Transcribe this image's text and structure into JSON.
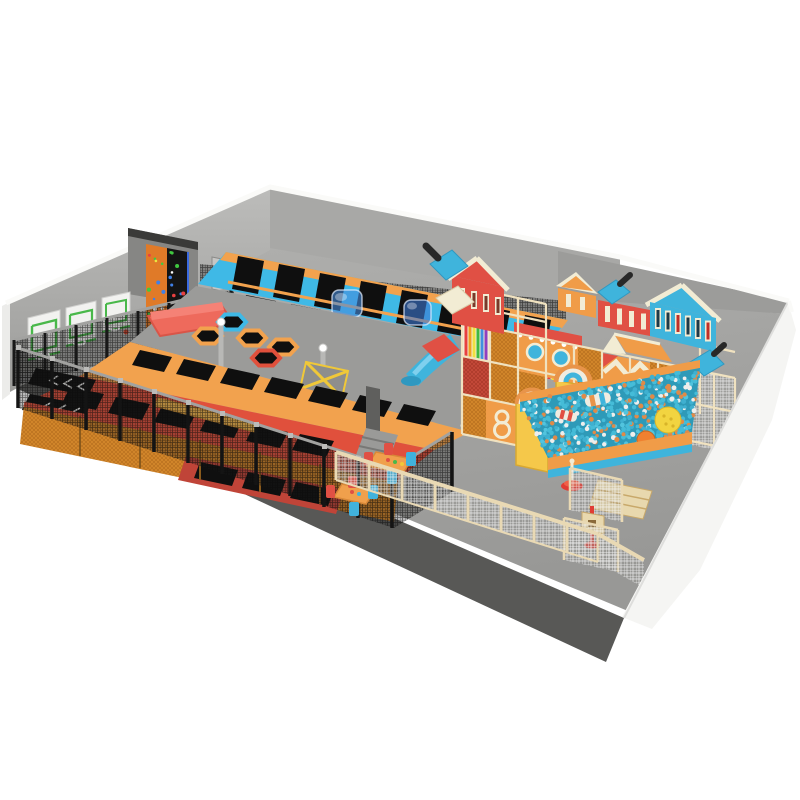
{
  "scene": {
    "kind": "indoor-playground-3d-render",
    "areas": {
      "trampoline_zone": "trampoline court with square, hexagon and wall-running trampolines",
      "soft_play": "multi-level soft play structure with houses and slides",
      "ball_pit": "ball pit with teal, white and orange balls",
      "basketball": "three wall basketball hoops",
      "climbing": "climbing wall panels",
      "seating": "kids tables and chairs"
    }
  },
  "palette": {
    "floor": "#a6a6a4",
    "floor_slab": "#585856",
    "wall_left": "#b4b4b2",
    "wall_back": "#a8a8a6",
    "wall_east": "#9c9c9a",
    "wall_white": "#f5f5f3",
    "edge_white": "#fafaf8",
    "door": "#c6c6c4",
    "net_dark": "#1c1c1c",
    "mesh_orange": "#d4882c",
    "lattice_cream": "#f0e2c0",
    "fence_beige": "#e9d9b4",
    "tramp_blue": "#3fb9e6",
    "tramp_orange": "#f2a24e",
    "tramp_red": "#e0503c",
    "lanes_red": "#c04438",
    "mat_black": "#0f0f0f",
    "deck_gray": "#9b9b99",
    "pad_salmon": "#ee6a5c",
    "beam_yellow": "#f2b64e",
    "accent_yellow": "#f0c838",
    "play_red": "#e05044",
    "play_blue": "#3fb4dc",
    "play_orange": "#f09c48",
    "cream": "#f2ecd4",
    "tower_yellow": "#f5c84a",
    "hoop_green": "#49b84a",
    "steel": "#9a9a98",
    "column_dark": "#5f5f5d",
    "chair_red": "#e05044",
    "chair_blue": "#41b2dc",
    "table_orange": "#f0a04c",
    "stand_red": "#e03c34",
    "steps_beige": "#e8d8ae",
    "ball_yellow": "#f2d440",
    "ball_orange_big": "#f08030"
  },
  "balls": {
    "colors": [
      "#45bcd8",
      "#3fb0d0",
      "#52c4de",
      "#eeeeec",
      "#e08a48",
      "#45bcd8"
    ],
    "pit_count": 540,
    "under_count": 90
  },
  "holds": {
    "colors": [
      "#e8e840",
      "#e84040",
      "#40c840",
      "#4080e8",
      "#ffffff",
      "#e88820"
    ],
    "count": 26
  }
}
